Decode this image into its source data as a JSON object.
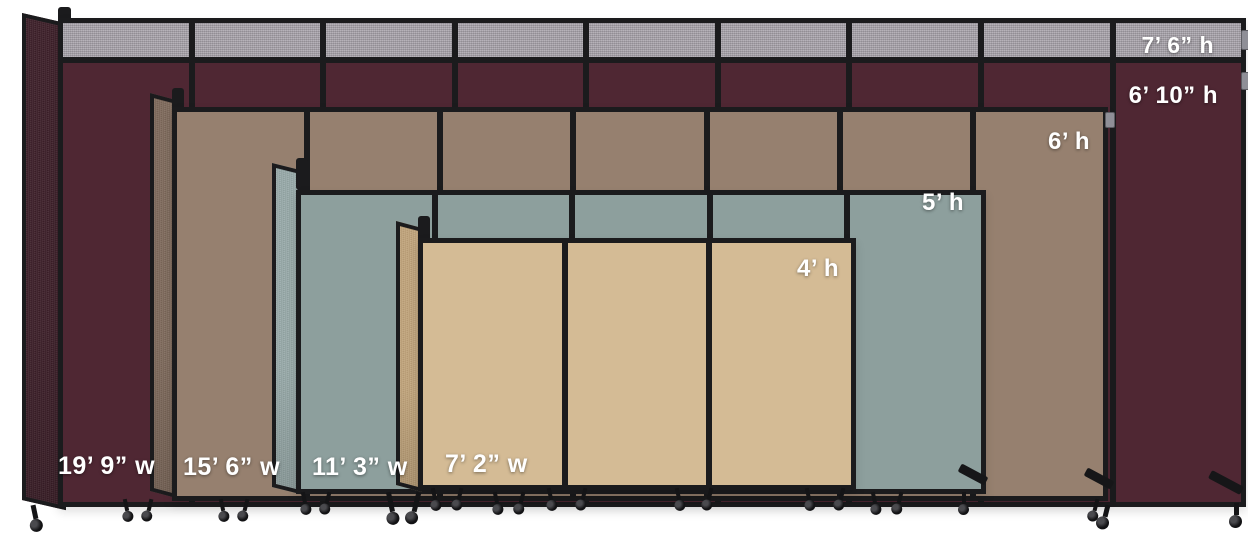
{
  "image": {
    "kind": "room-divider size comparison product image",
    "background_hex": "#ffffff",
    "frame_hex": "#1b1b1d",
    "label_text_hex": "#ffffff"
  },
  "partitions": [
    {
      "name": "partition-7ft6-cranberry",
      "fabric_hex": "#4f2733",
      "end_panel_hex": "#3d1f29",
      "topper_fabric_hex": "#a7a2aa",
      "panel_count": 9,
      "height_label": "7’ 6” h",
      "body_height_label": "6’ 10” h",
      "width_label": "19’ 9” w"
    },
    {
      "name": "partition-6ft-mocha",
      "fabric_hex": "#96806f",
      "end_panel_hex": "#7f6a5c",
      "panel_count": 7,
      "height_label": "6’ h",
      "width_label": "15’ 6” w"
    },
    {
      "name": "partition-5ft-slate",
      "fabric_hex": "#8d9f9d",
      "end_panel_hex": "#99abaa",
      "panel_count": 5,
      "height_label": "5’ h",
      "width_label": "11’ 3” w"
    },
    {
      "name": "partition-4ft-sand",
      "fabric_hex": "#d4bb95",
      "end_panel_hex": "#c2a57c",
      "panel_count": 3,
      "height_label": "4’ h",
      "width_label": "7’ 2” w"
    }
  ]
}
